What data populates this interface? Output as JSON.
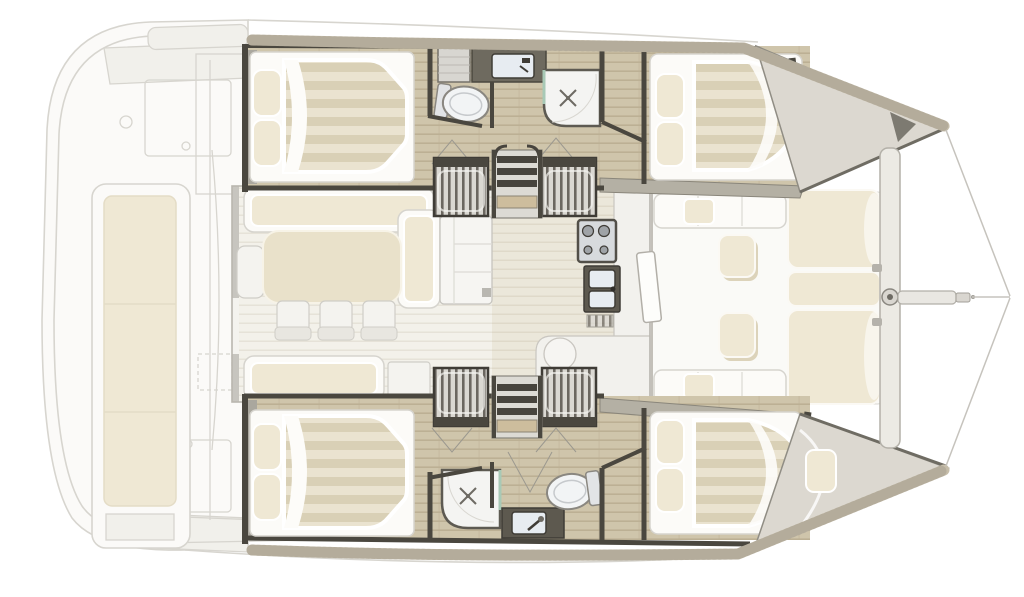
{
  "diagram": {
    "type": "floorplan",
    "subject": "Sailing catamaran interior layout, top view, bow pointing right",
    "areas": [
      "aft cockpit with long bench seat",
      "salon with L-shaped sofa, dining table and three chairs",
      "aft salon sofa",
      "storage cabinet beside companionway",
      "galley with stove, double sink and round basin",
      "central companionway ladders to both hulls",
      "port hull aft cabin with double berth and pillows",
      "port hull bathroom with vanity sink, toilet and shower",
      "port hull forward cabin with double berth",
      "starboard hull aft cabin with double berth and pillows",
      "starboard hull bathroom with shower, vanity sink and toilet",
      "starboard hull forward cabin with double berth",
      "forward cockpit with U-shaped seating, two ottomans and three sunpads",
      "port bow anchor locker",
      "starboard bow with cushion",
      "forward crossbeam with mast-step fitting and bowsprit",
      "bridle lines to the bows"
    ],
    "counts": {
      "double_berths": 4,
      "bathrooms": 2,
      "toilets": 2,
      "showers": 2,
      "companionway_steps": 4,
      "dining_chairs": 3,
      "ottomans": 2,
      "sunpads": 3
    }
  },
  "colors": {
    "background": "#ffffff",
    "outline_faint": "#d7d5cf",
    "deck_faint_fill": "#fbfaf8",
    "panel_faint": "#f1f0eb",
    "cushion_cream": "#efe8d4",
    "table_cream": "#e9e1ca",
    "mattress_stripe_light": "#eae3d0",
    "mattress_stripe_dark": "#d9d0b6",
    "wood_light": "#cfc5ab",
    "wood_dark": "#bcb094",
    "salon_plank_light": "#f3f1ea",
    "salon_plank_line": "#e3dfd3",
    "corridor_light": "#ebe7da",
    "corridor_line": "#dcd6c5",
    "bulkhead_dark": "#4a473f",
    "wall_gray": "#aaa79e",
    "gunwale_tan": "#c6bda9",
    "bow_deck": "#dcd8d0",
    "fixture_white": "#f2f4f5",
    "fixture_stroke": "#8a8780",
    "counter_dark": "#5d594f",
    "sink_blue": "#e7ecf1",
    "glass_green": "#a8c9b6",
    "step_stripe_dark": "#6b6760",
    "step_stripe_light": "#dad8d2",
    "beam_fill": "#eceae4",
    "beam_stroke": "#b3b0a8",
    "line_rig": "#c6c3bd"
  }
}
